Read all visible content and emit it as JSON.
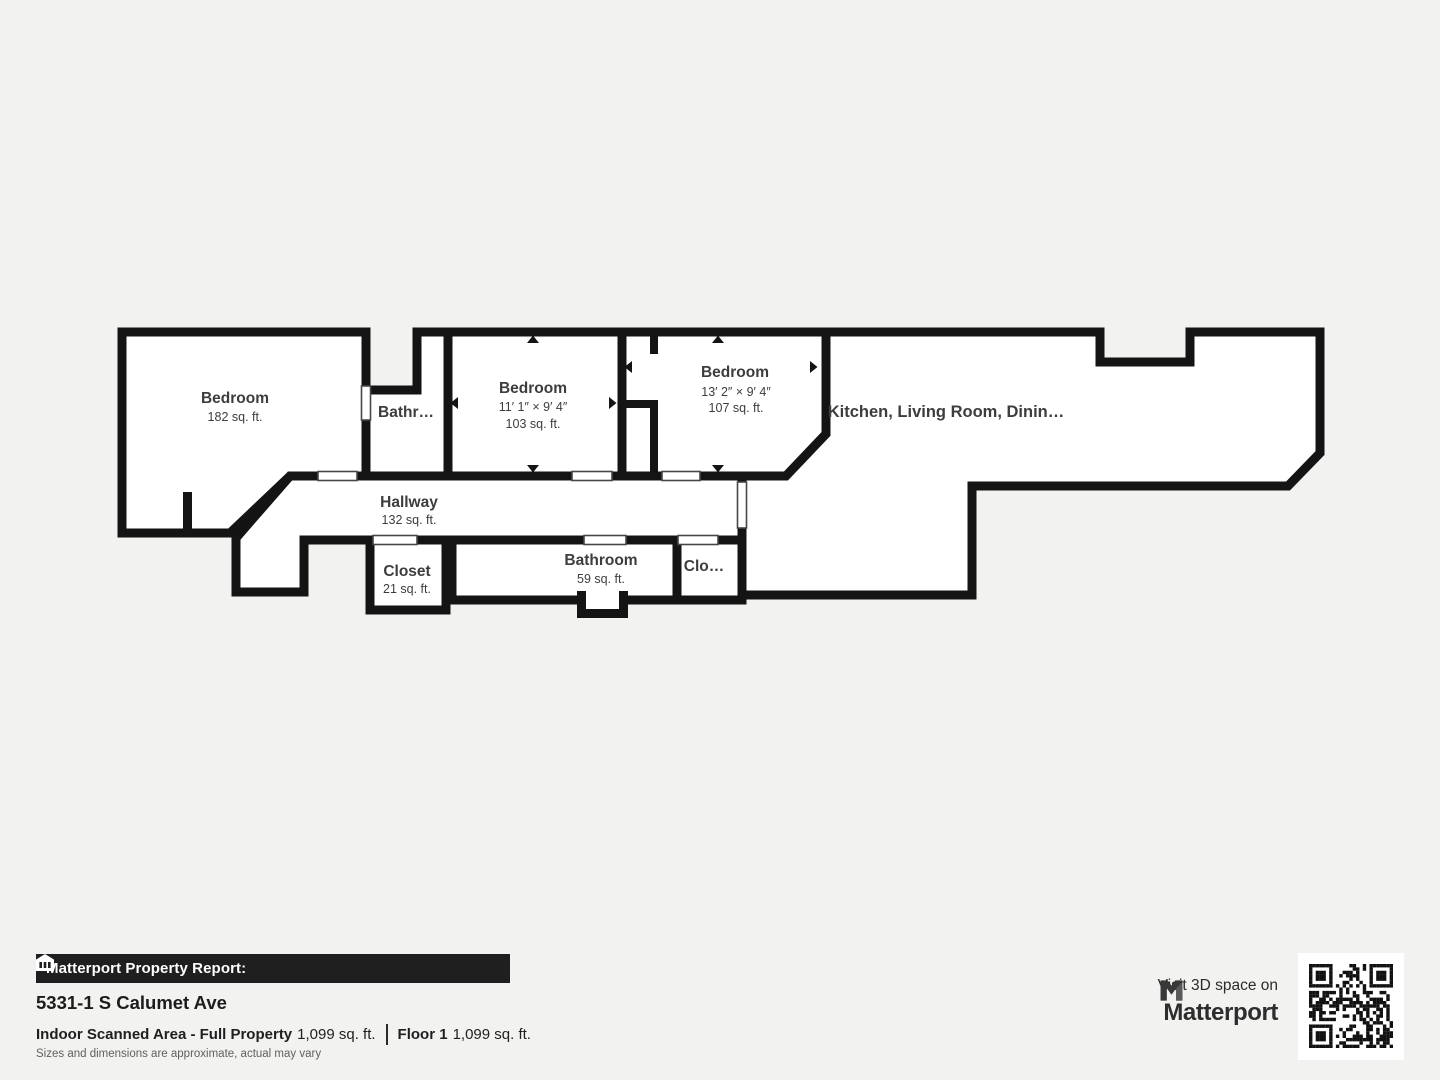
{
  "plan": {
    "rooms": {
      "bedroom_left": {
        "name": "Bedroom",
        "area": "182 sq. ft."
      },
      "bathroom_top": {
        "name": "Bathr…"
      },
      "bedroom_mid": {
        "name": "Bedroom",
        "dims": "11′ 1″ × 9′ 4″",
        "area": "103 sq. ft."
      },
      "bedroom_right": {
        "name": "Bedroom",
        "dims": "13′ 2″ × 9′ 4″",
        "area": "107 sq. ft."
      },
      "great_room": {
        "name": "Kitchen, Living Room, Dinin…"
      },
      "hallway": {
        "name": "Hallway",
        "area": "132 sq. ft."
      },
      "closet_left": {
        "name": "Closet",
        "area": "21 sq. ft."
      },
      "bathroom_bottom": {
        "name": "Bathroom",
        "area": "59 sq. ft."
      },
      "closet_right": {
        "name": "Clo…"
      }
    }
  },
  "report": {
    "bar_title": "Matterport Property Report:",
    "address": "5331-1 S Calumet Ave",
    "area_label": "Indoor Scanned Area - Full Property",
    "area_value": "1,099 sq. ft.",
    "floor_label": "Floor 1",
    "floor_value": "1,099 sq. ft.",
    "disclaimer": "Sizes and dimensions are approximate, actual may vary"
  },
  "cta": {
    "line": "Visit 3D space on",
    "brand": "Matterport"
  },
  "icons": {
    "bar_icon": "house-icon",
    "brand_icon": "matterport-logo-icon",
    "qr": "qr-code"
  },
  "colors": {
    "background": "#f2f2f0",
    "wall": "#141414",
    "room_fill": "#ffffff",
    "label_text": "#3d3d3d",
    "bar_background": "#1f1f1f",
    "bar_text": "#ffffff",
    "footer_text": "#1c1c1c",
    "disclaimer_text": "#5f5f5f"
  }
}
